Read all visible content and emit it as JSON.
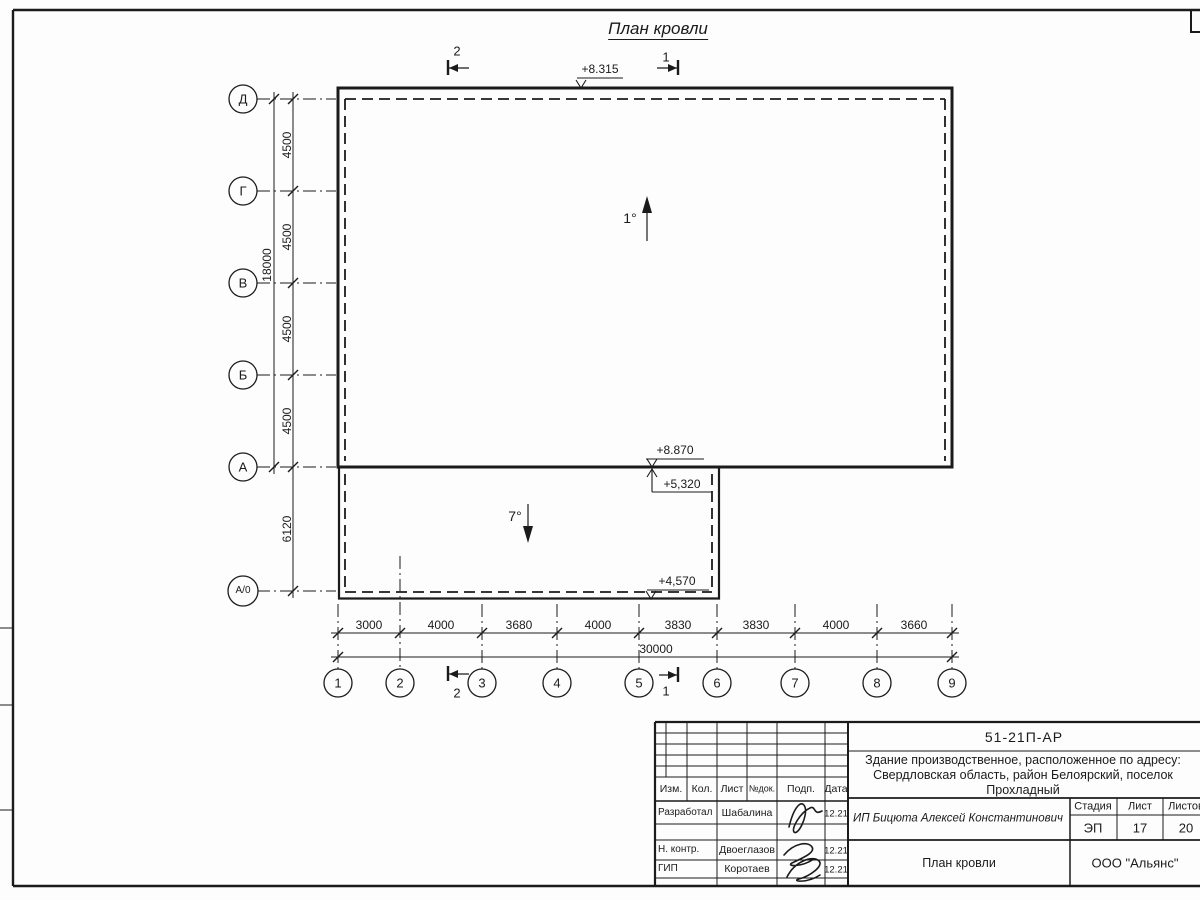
{
  "drawing": {
    "title": "План кровли",
    "row_axes": [
      "Д",
      "Г",
      "В",
      "Б",
      "А",
      "А/0"
    ],
    "col_axes": [
      "1",
      "2",
      "3",
      "4",
      "5",
      "6",
      "7",
      "8",
      "9"
    ],
    "row_dims": [
      "4500",
      "4500",
      "4500",
      "4500"
    ],
    "row_dim_annex": "6120",
    "row_dim_total": "18000",
    "col_dims": [
      "3000",
      "4000",
      "3680",
      "4000",
      "3830",
      "3830",
      "4000",
      "3660"
    ],
    "col_dim_total": "30000",
    "elevations": {
      "main_roof": "+8.315",
      "main_roof_edge": "+8.870",
      "annex_roof_top": "+5,320",
      "annex_roof_edge": "+4,570"
    },
    "slopes": {
      "main_roof": "1°",
      "annex_roof": "7°"
    },
    "section_marks": {
      "mark1": "1",
      "mark2": "2"
    }
  },
  "title_block": {
    "doc_code": "51-21П-АР",
    "project_line1": "Здание производственное, расположенное по адресу:",
    "project_line2": "Свердловская область, район Белоярский, поселок",
    "project_line3": "Прохладный",
    "client": "ИП Бицюта Алексей Константинович",
    "sheet_name": "План кровли",
    "organization": "ООО \"Альянс\"",
    "stage_label": "Стадия",
    "sheet_label": "Лист",
    "sheets_label": "Листов",
    "stage_value": "ЭП",
    "sheet_value": "17",
    "sheets_value": "20",
    "col_izm": "Изм.",
    "col_kol": "Кол.",
    "col_list": "Лист",
    "col_ndoc": "№док.",
    "col_podp": "Подп.",
    "col_data": "Дата",
    "signature_rows": [
      {
        "role": "Разработал",
        "name": "Шабалина",
        "date": "12.21"
      },
      {
        "role": "Н. контр.",
        "name": "Двоеглазов",
        "date": "12.21"
      },
      {
        "role": "ГИП",
        "name": "Коротаев",
        "date": "12.21"
      }
    ]
  }
}
